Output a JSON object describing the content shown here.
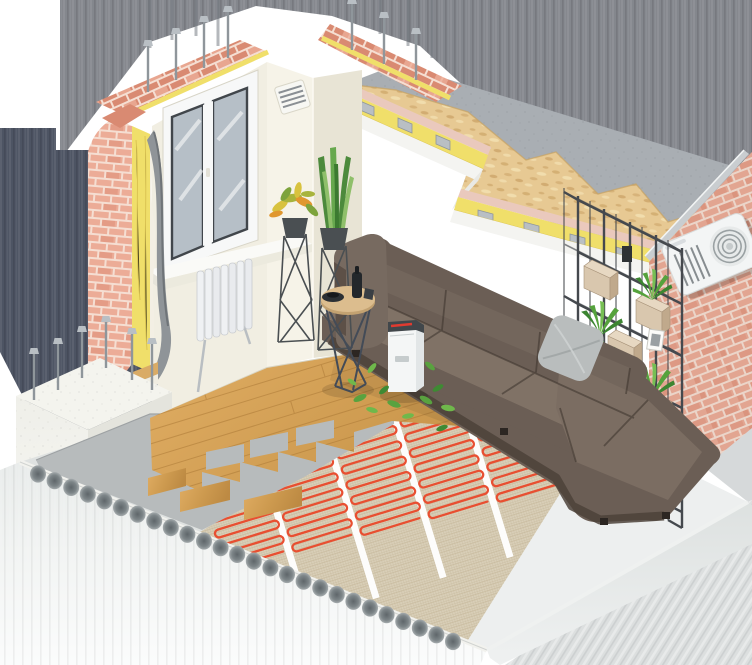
{
  "objects": {
    "scene": "isometric-room-construction-cutaway",
    "backdrop": "blurred-grey-backdrop",
    "ceiling": "ceiling-cutaway-layers",
    "osb": "osb-chipboard-layer",
    "slab": "concrete-ceiling-slab",
    "insulation": "mineral-wool-insulation-strips",
    "drywall": "drywall-ceiling-layer",
    "left_wall": "window-wall-cutaway",
    "window": "double-pane-window",
    "radiator": "sectional-radiator",
    "vent": "ventilation-grille",
    "block": "aerated-concrete-block-with-anchors",
    "right_wall": "exterior-brick-wall",
    "ac": "air-conditioner-outdoor-unit",
    "shelving": "wire-frame-shelving-with-plants",
    "sofa": "corner-leather-sofa",
    "pillow": "grey-cushion",
    "table": "round-coffee-table",
    "purifier": "air-purifier",
    "leaves": "floating-green-leaves",
    "plant1": "croton-plant-on-stand",
    "plant2": "snake-plant-on-stand",
    "floor_wood": "laminate-floor-planks",
    "underlay": "grey-floor-underlay",
    "heating": "electric-underfloor-heating-mat",
    "screed": "white-floor-screed",
    "slab_floor": "hollow-core-concrete-floor-slab"
  },
  "palette": {
    "bg": "#ffffff",
    "backdrop": "#84878d",
    "backdropDark": "#4d5463",
    "backdropLight": "#d6d9da",
    "wall": "#f1eee2",
    "wallShade": "#e8e4d5",
    "wallLight": "#f6f3e8",
    "brick": "#ecac97",
    "mortar": "#f5ded2",
    "brickDeep": "#d98a72",
    "osb": "#e7c993",
    "osbDot": "#c49a5b",
    "slab": "#a9aeb3",
    "slabDark": "#969ca4",
    "drywall": "#f4f4f1",
    "insul": "#f0df6a",
    "insulDark": "#d2b848",
    "pinkBoard": "#eac9bd",
    "steel": "#b9bfc4",
    "steelDark": "#8f969b",
    "wood": "#d2a055",
    "woodDark": "#b5803b",
    "woodLine": "#a87634",
    "underlay": "#b7bbbc",
    "mat": "#d9cfb8",
    "matLine": "#c3b598",
    "cable": "#e84f31",
    "screed": "#edefef",
    "screedLine": "#d9dddd",
    "slabFace": "#eaedec",
    "hole": "#7c8487",
    "block": "#efefe9",
    "sofa": "#6b5e55",
    "sofaTop": "#807266",
    "sofaMid": "#73665c",
    "sofaDark": "#4c423a",
    "sofaEdge": "#3c332c",
    "pillow": "#b9bdbd",
    "tableWood": "#dcbd8e",
    "wire": "#434b57",
    "white": "#f4f6f6",
    "purTop": "#41474b",
    "red": "#e03b30",
    "leaf": "#55a23c",
    "leafDark": "#3c8531",
    "leafLight": "#76bf54",
    "pot": "#4a4f52",
    "shelfWood": "#d9c7ae",
    "shelfWoodSide": "#c0a98c",
    "shelfWire": "#45494e",
    "glass": "#b6bfc7",
    "glassDark": "#41464b",
    "frame": "#f7f8f8"
  }
}
